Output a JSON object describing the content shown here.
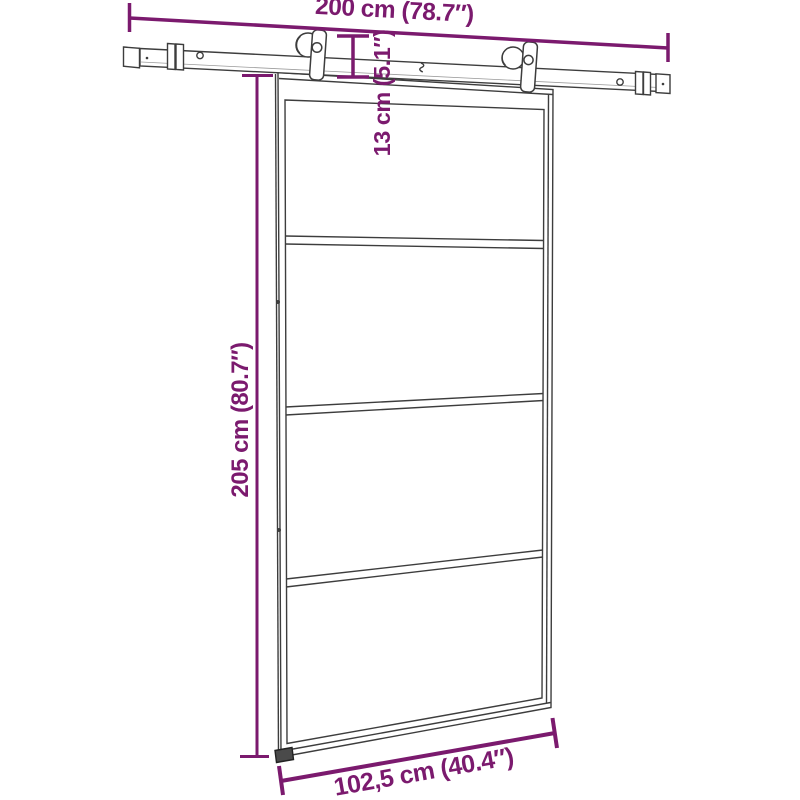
{
  "diagram": {
    "kind": "sliding-door-dimension-diagram",
    "panel_count": 4,
    "colors": {
      "dimension_accent": "#7b1a6e",
      "line_art": "#3d3d3d",
      "background": "#ffffff",
      "floor_guide_fill": "#4a4a4a"
    },
    "dimensions": {
      "rail_length": "200 cm (78.7″)",
      "rail_to_door_gap": "13 cm (5.1″)",
      "door_height": "205 cm (80.7″)",
      "door_width": "102,5 cm (40.4″)"
    }
  }
}
